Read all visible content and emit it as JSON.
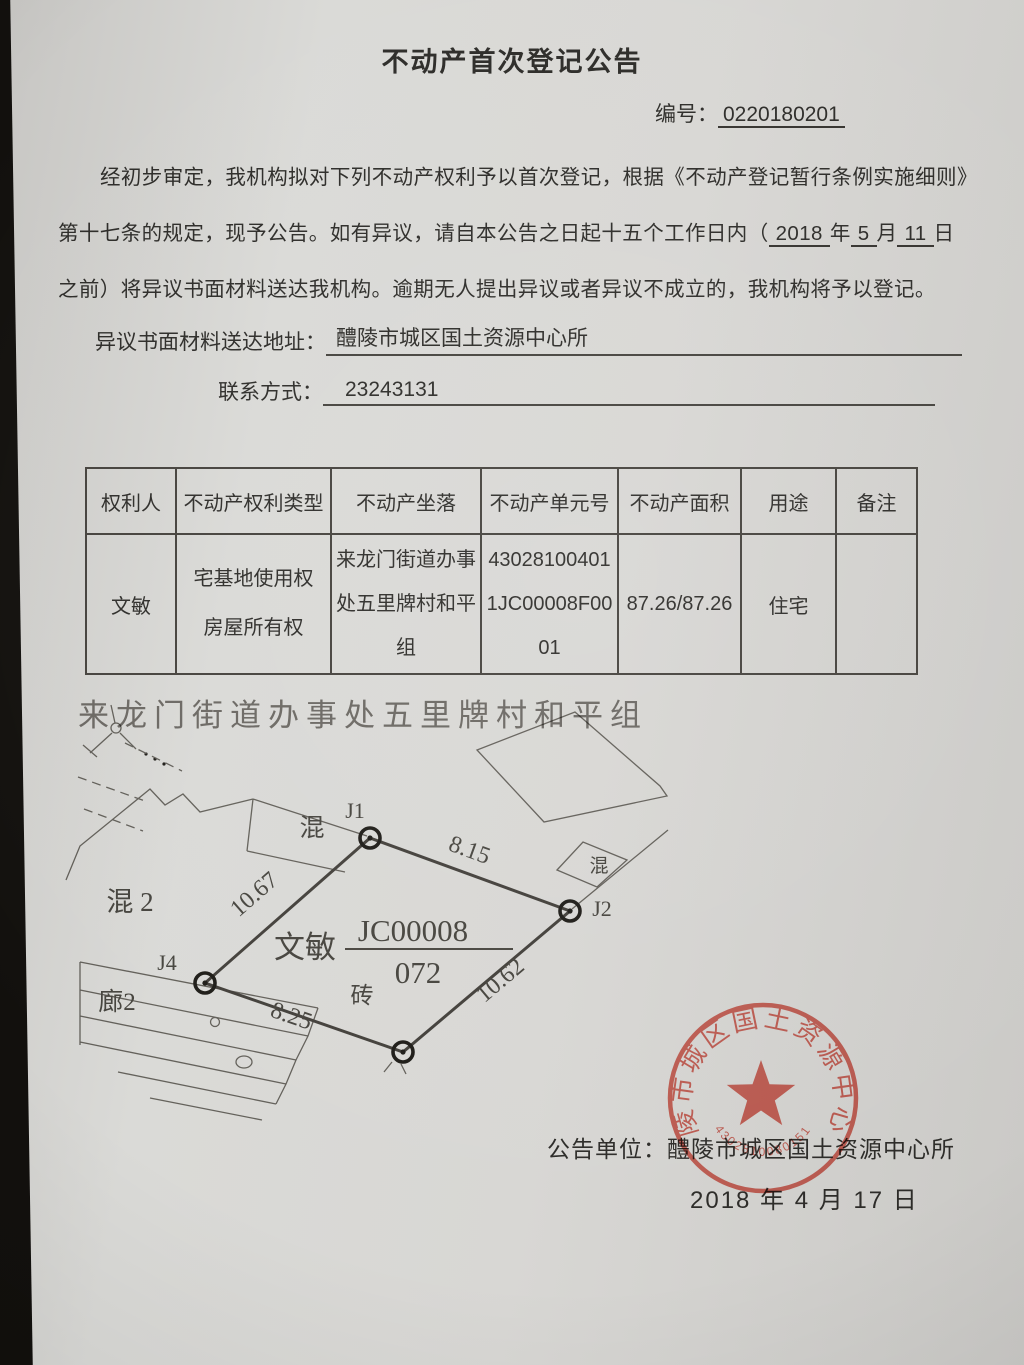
{
  "doc": {
    "title": "不动产首次登记公告",
    "serial_label": "编号：",
    "serial_value": "0220180201",
    "para_line1": "经初步审定，我机构拟对下列不动产权利予以首次登记，根据《不动产登记暂行条例实施细则》",
    "para_line2_prefix": "第十七条的规定，现予公告。如有异议，请自本公告之日起十五个工作日内（",
    "blank_year": "2018",
    "unit_year": "年",
    "blank_month": "5",
    "unit_month": "月",
    "blank_day": "11",
    "unit_day": "日",
    "para_line3": "之前）将异议书面材料送达我机构。逾期无人提出异议或者异议不成立的，我机构将予以登记。",
    "address_label": "异议书面材料送达地址：",
    "address_value": "醴陵市城区国土资源中心所",
    "contact_label": "联系方式：",
    "contact_value": "23243131"
  },
  "table": {
    "headers": [
      "权利人",
      "不动产权利类型",
      "不动产坐落",
      "不动产单元号",
      "不动产面积",
      "用途",
      "备注"
    ],
    "row": {
      "holder": "文敏",
      "right_type_1": "宅基地使用权",
      "right_type_2": "房屋所有权",
      "location_1": "来龙门街道办事",
      "location_2": "处五里牌村和平",
      "location_3": "组",
      "unit_no_1": "43028100401",
      "unit_no_2": "1JC00008F00",
      "unit_no_3": "01",
      "area": "87.26/87.26",
      "usage": "住宅",
      "remark": ""
    }
  },
  "diagram": {
    "title": "来龙门街道办事处五里牌村和平组",
    "owner": "文敏",
    "parcel_code": "JC00008",
    "parcel_sub": "072",
    "material": "砖",
    "point_j1": "J1",
    "point_j2": "J2",
    "point_j4": "J4",
    "len_j1_j2": "8.15",
    "len_j2_j3": "10.62",
    "len_j3_j4": "8.25",
    "len_j4_j1": "10.67",
    "label_building_top": "混",
    "label_building_left": "混 2",
    "label_building_right": "混",
    "label_building_bottom": "廊2"
  },
  "stamp": {
    "ring_text": "醴陵市城区国土资源中心所",
    "code": "4302810080151",
    "color": "#dd5a4e"
  },
  "footer": {
    "issuer_label": "公告单位：",
    "issuer_value": "醴陵市城区国土资源中心所",
    "date_line": "2018 年 4 月 17 日"
  }
}
